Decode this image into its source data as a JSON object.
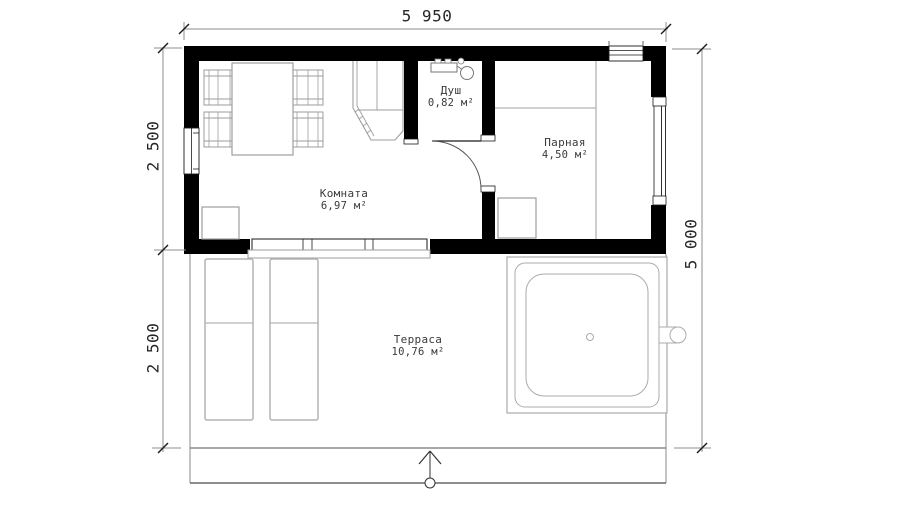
{
  "plan": {
    "type": "floor-plan",
    "dimensions": {
      "width_top": "5 950",
      "left_upper": "2 500",
      "left_lower": "2 500",
      "height_right": "5 000"
    },
    "rooms": [
      {
        "name": "Душ",
        "area": "0,82 м²"
      },
      {
        "name": "Парная",
        "area": "4,50 м²"
      },
      {
        "name": "Комната",
        "area": "6,97 м²"
      },
      {
        "name": "Терраса",
        "area": "10,76 м²"
      }
    ],
    "colors": {
      "wall": "#000000",
      "furniture_line": "#9e9e9e",
      "light_line": "#b3b3b3",
      "dimension_line": "#8c8c8c",
      "tick": "#1a1a1a",
      "text": "#2e2e2e",
      "background": "#ffffff"
    }
  }
}
